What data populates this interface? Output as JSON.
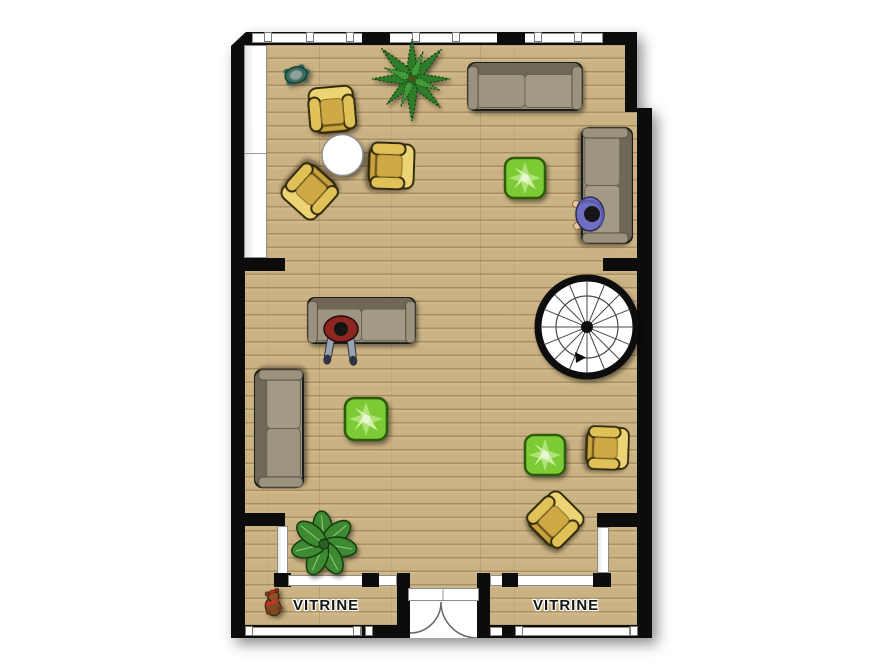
{
  "scene": {
    "type": "floor-plan",
    "labels": {
      "vitrine_left": "VITRINE",
      "vitrine_right": "VITRINE"
    },
    "colors": {
      "background": "#ffffff",
      "wall": "#0c0c0c",
      "floor_wood": "#cbb282",
      "floor_plank_line": "#9e8a5f",
      "window_white": "#ffffff",
      "window_frame_gray": "#8d8d8d",
      "armchair_yellow": "#c9a33c",
      "armchair_yellow_light": "#ecd474",
      "sofa_gray": "#948c79",
      "sofa_gray_dark": "#6f6856",
      "cube_green": "#7ccb35",
      "cube_green_border": "#2f5c0f",
      "fern_green": "#2f7d2c",
      "plant_leaf_green": "#3e8a33",
      "person_shirt_blue": "#6e6fc2",
      "person_shirt_red": "#8c2620",
      "jeans_gray_blue": "#9aa3b5",
      "teddy_brown": "#7d4b24",
      "table_white": "#ffffff",
      "stair_ring_black": "#0c0c0c"
    },
    "objects": [
      "turtle-figurine",
      "fern-plant",
      "two-seat-sofa-top-wall",
      "yellow-armchair-1",
      "yellow-armchair-2",
      "yellow-armchair-3",
      "round-white-coffee-table",
      "green-cube-table-1",
      "two-seat-sofa-right-wall",
      "person-sitting-blue-shirt",
      "two-seat-sofa-center",
      "person-sitting-red-shirt",
      "spiral-staircase",
      "two-seat-sofa-left-wall",
      "green-cube-table-2",
      "green-cube-table-3",
      "yellow-armchair-4",
      "yellow-armchair-5",
      "broadleaf-plant",
      "teddy-bear",
      "double-entry-door"
    ]
  }
}
